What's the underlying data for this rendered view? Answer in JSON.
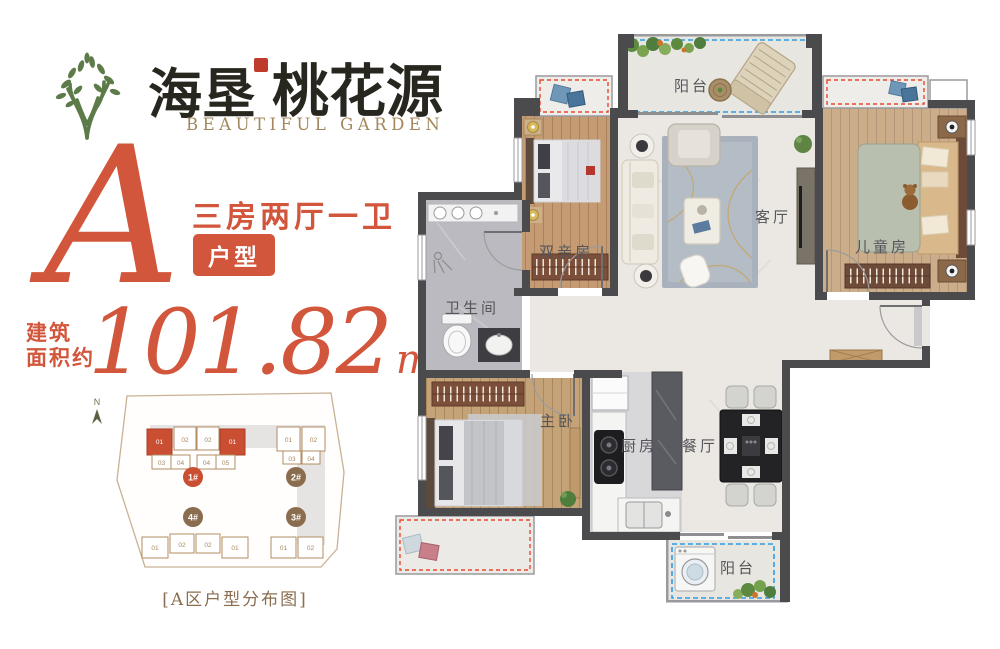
{
  "brand": {
    "name_main": "海垦",
    "name_sub": "桃花源",
    "english": "BEAUTIFUL GARDEN"
  },
  "unit": {
    "letter": "A",
    "layout": "三房两厅一卫",
    "badge": "户型",
    "area_label_line1": "建筑",
    "area_label_line2": "面积约",
    "area_value": "101.82",
    "area_unit": "m",
    "area_exponent": "2"
  },
  "site_plan": {
    "north": "N",
    "caption": "[A区户型分布图]",
    "b1": {
      "label": "1#",
      "top": [
        "01",
        "02",
        "02",
        "01"
      ],
      "bottom": [
        "03",
        "04",
        "04",
        "05"
      ]
    },
    "b2": {
      "label": "2#",
      "top": [
        "01",
        "02"
      ],
      "bottom": [
        "03",
        "04"
      ]
    },
    "b3": {
      "label": "3#",
      "units": [
        "01",
        "02"
      ]
    },
    "b4": {
      "label": "4#",
      "units": [
        "01",
        "02",
        "02",
        "01"
      ]
    }
  },
  "floor_plan": {
    "labels": {
      "balcony_top": "阳台",
      "parents_room": "双亲房",
      "living_room": "客厅",
      "children_room": "儿童房",
      "bathroom": "卫生间",
      "master_room": "主卧",
      "kitchen": "厨房",
      "dining_room": "餐厅",
      "balcony_bottom": "阳台"
    }
  },
  "colors": {
    "accent_orange": "#d2563b",
    "brand_green": "#5c7b48",
    "text_brown": "#8a6d4f",
    "wall_dark": "#4b4b4d",
    "dash_blue": "#2f9ce3",
    "dash_red": "#e84a2e",
    "highlight_red": "#c94e32"
  }
}
